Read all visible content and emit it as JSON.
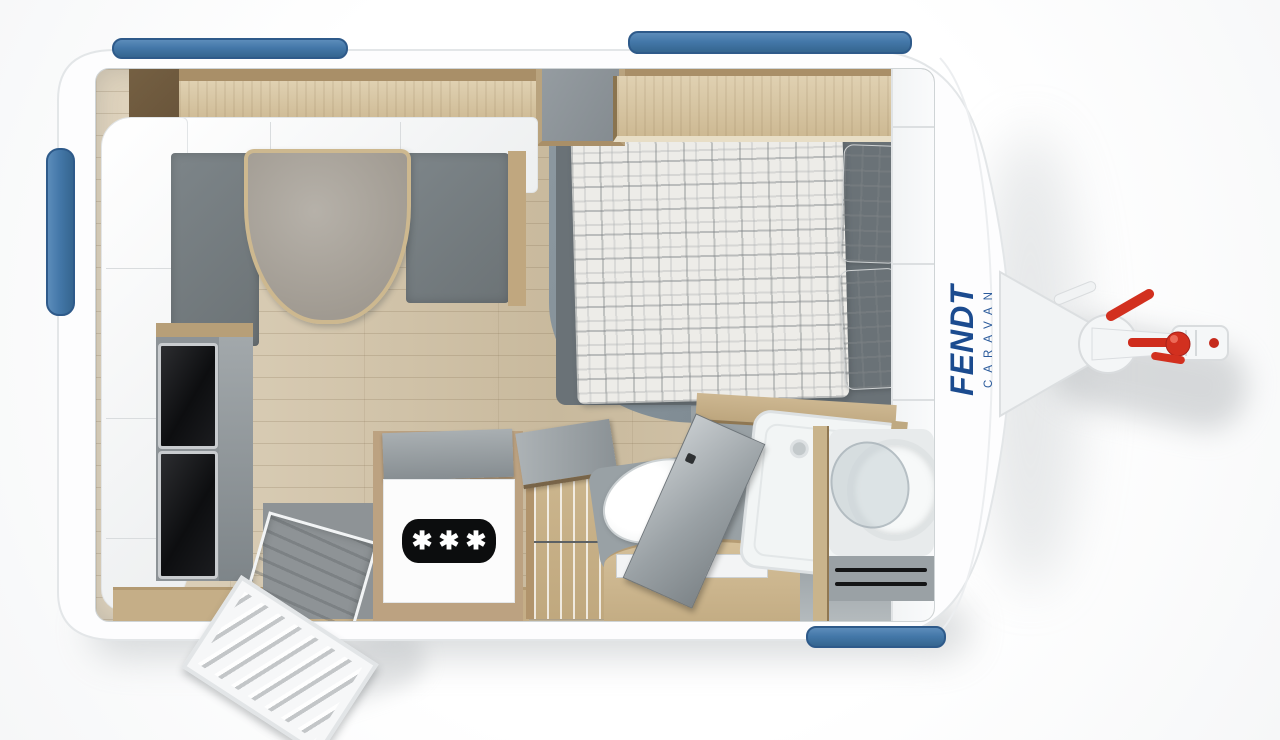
{
  "title": "Fendt caravan floor plan",
  "brand": {
    "name": "FENDT",
    "sub": "CARAVAN"
  },
  "cooker": {
    "stars": "✱✱✱"
  },
  "colors": {
    "window_blue": "#4478a9",
    "window_blue_dark": "#2e5a8a",
    "brand_blue": "#1b4b8f",
    "hitch_red": "#d2301f",
    "wood_light": "#d9c8a8",
    "wood_mid": "#c5ae87",
    "wood_dark": "#6f5a3e",
    "floor_wood": "#d3c3a5",
    "cushion_gray": "#757d81",
    "bed_platform_gray": "#87939a",
    "bathroom_floor_gray": "#9ba3a7",
    "appliance_black": "#131416",
    "shell_white": "#fdfdfe"
  }
}
